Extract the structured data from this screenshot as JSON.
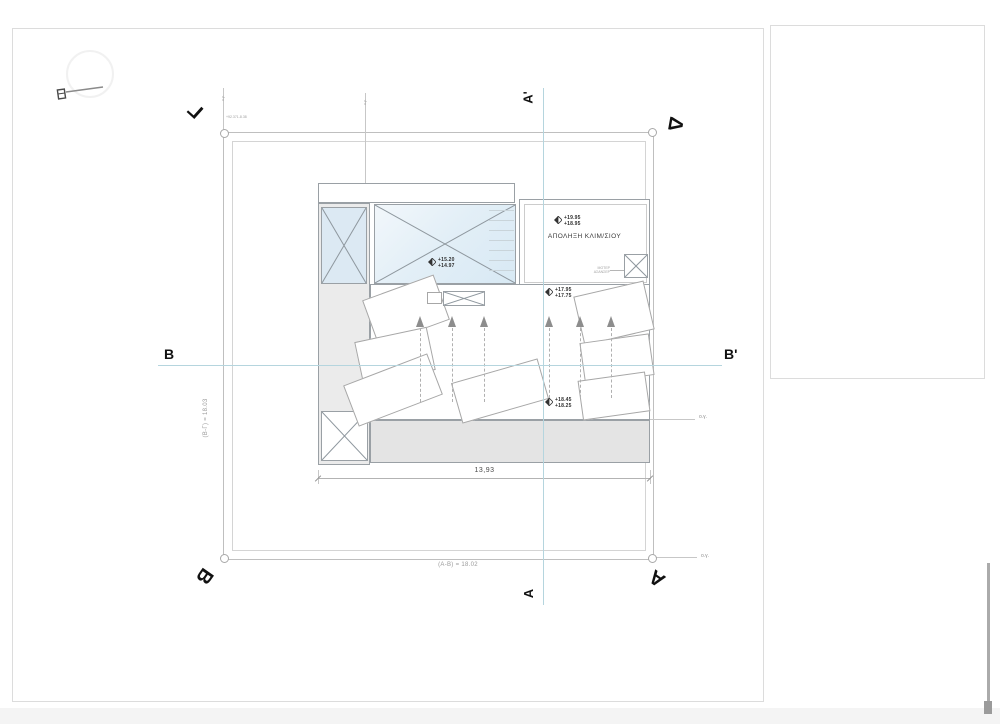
{
  "document": {
    "survey_note": "+92.371-8.38"
  },
  "plot": {
    "corner_labels": {
      "top_left": "Γ",
      "top_right": "Δ",
      "bottom_left": "Β",
      "bottom_right": "Α"
    },
    "edge_dimensions": {
      "bottom": "(Α-Β) = 18.02",
      "left": "(Β-Γ) = 18.03"
    },
    "notes": {
      "og_mid_right": "ο.γ.",
      "og_bottom_right": "ο.γ.",
      "og_guide_1": "ο.γ.",
      "og_guide_2": "ο.γ."
    }
  },
  "sections": {
    "a_top": "Α'",
    "a_bottom": "Α",
    "b_left": "Β",
    "b_right": "Β'"
  },
  "building": {
    "room_label": "ΑΠΟΛΗΞΗ ΚΛΙΜ/ΣΙΟΥ",
    "motor_label": "ΜΟΤΕΡ ΑΣΑΝΣΕΡ",
    "width_dimension": "13,93",
    "levels": {
      "stair_room": {
        "top": "+19.95",
        "bottom": "+18.95"
      },
      "skylight": {
        "top": "+15.20",
        "bottom": "+14.97"
      },
      "roof_upper": {
        "top": "+17.95",
        "bottom": "+17.75"
      },
      "roof_lower": {
        "top": "+18.45",
        "bottom": "+18.25"
      }
    }
  },
  "colors": {
    "section_line": "#b5d5de",
    "boundary_line": "#bfbfbf",
    "building_line": "#8f9498",
    "gray_fill": "#e6e6e6",
    "blue_fill": "#dce9f3"
  }
}
